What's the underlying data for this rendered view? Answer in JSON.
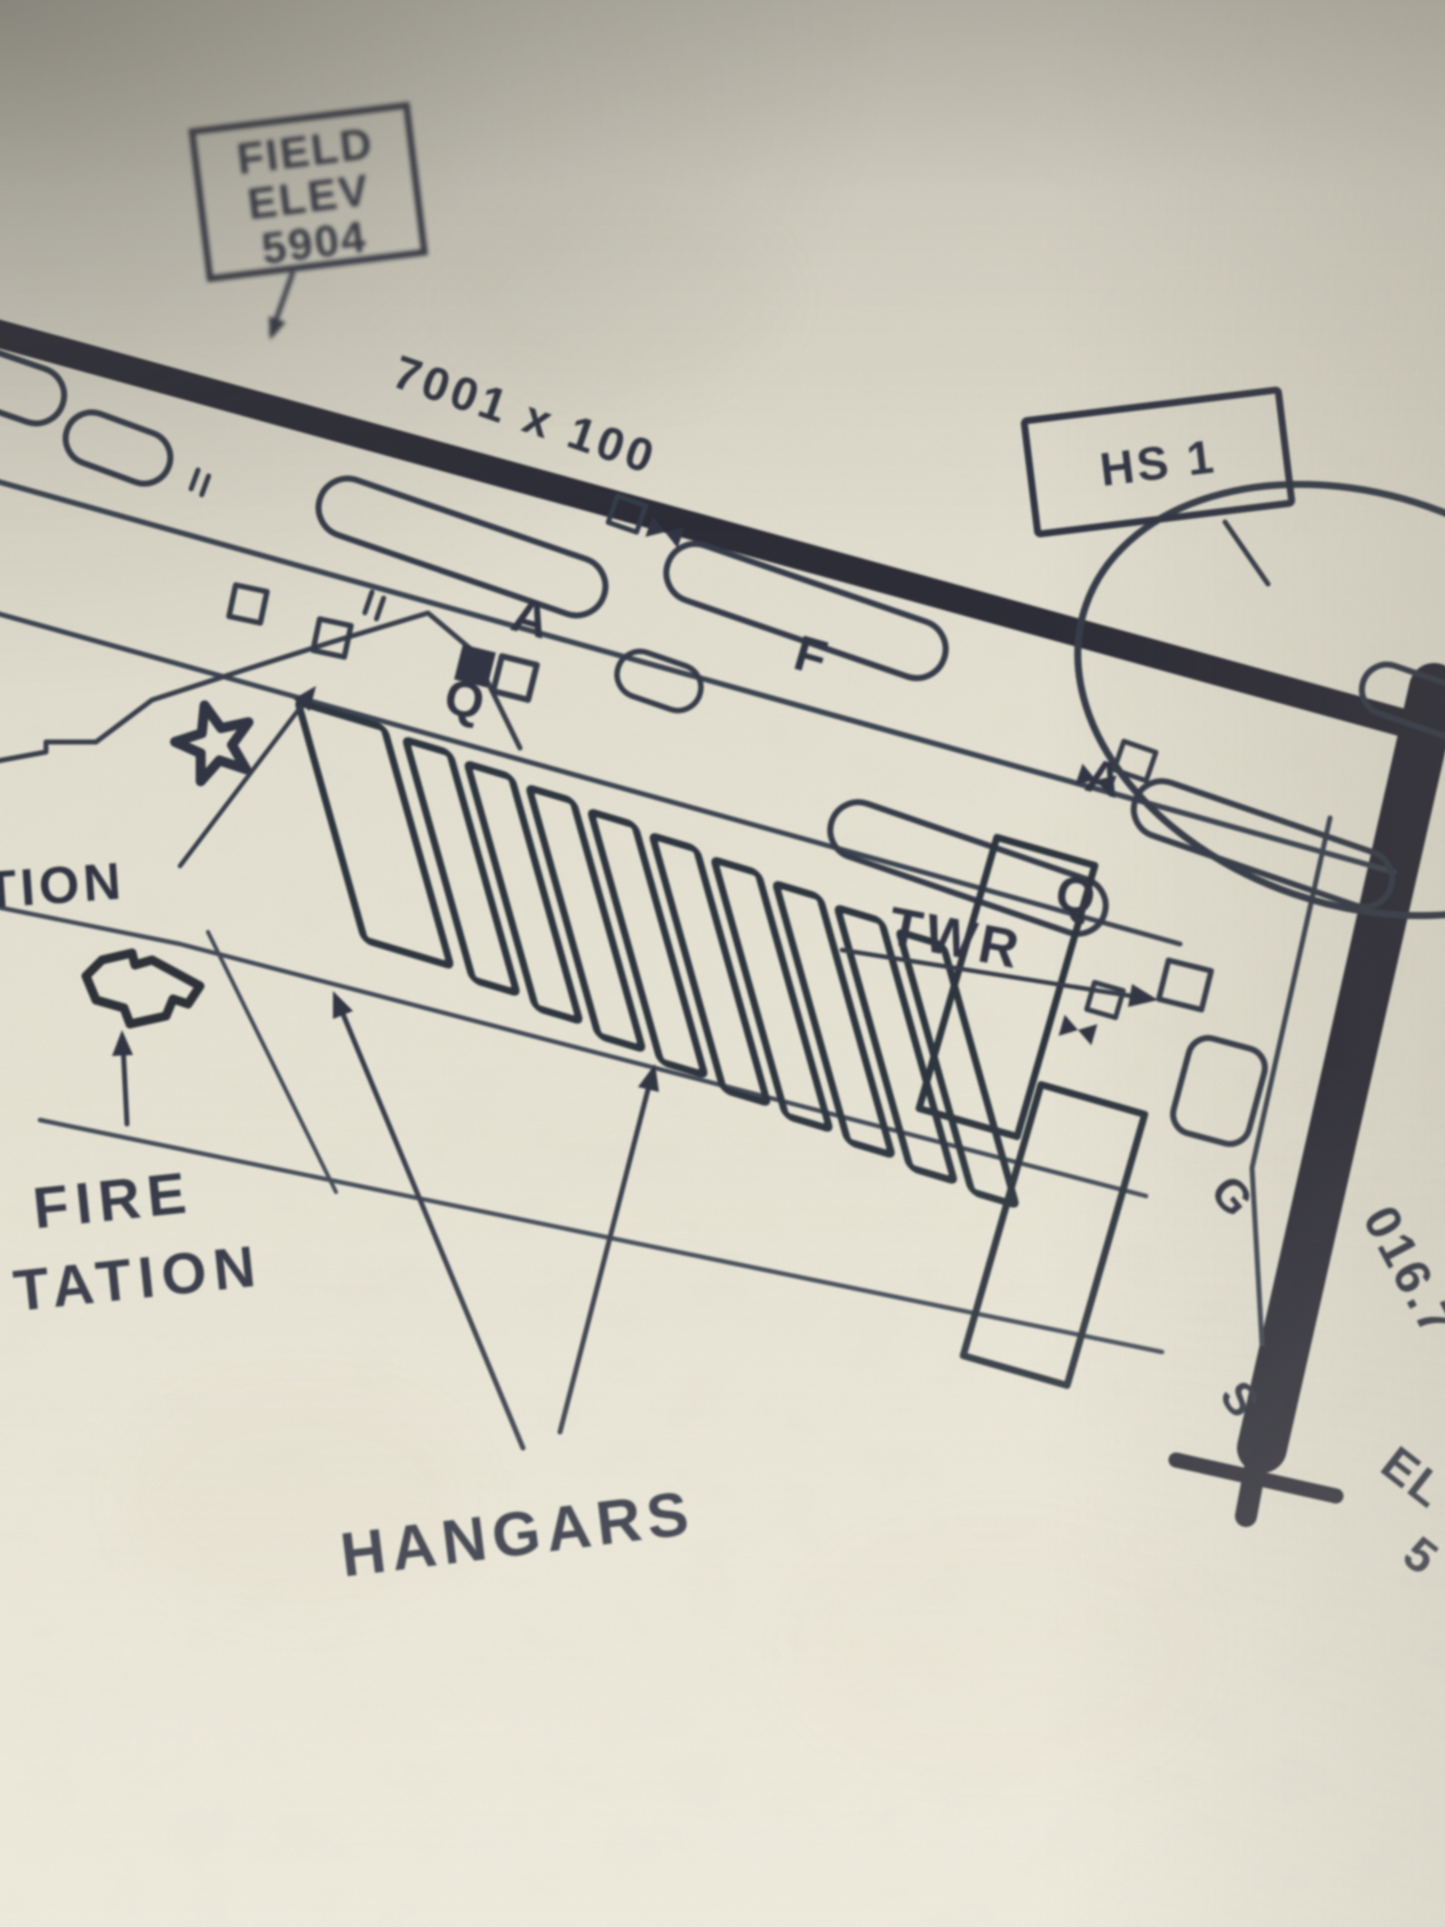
{
  "colors": {
    "paper": "#e7e4d5",
    "paper_dark": "#d3d0c4",
    "ink": "#262c3a",
    "runway_ink": "#20242e"
  },
  "labels": {
    "field_elev": {
      "line1": "FIELD",
      "line2": "ELEV",
      "line3": "5904"
    },
    "runway_size": "7001 x 100",
    "hot_spot": "HS 1",
    "taxiway_a_1": "A",
    "taxiway_q_1": "Q",
    "taxiway_f": "F",
    "taxiway_a_2": "A",
    "taxiway_q_2": "Q",
    "taxiway_g": "G",
    "taxiway_s": "S",
    "tower": "TWR",
    "clipped_station_top": "TION",
    "fire_station_line1": "FIRE",
    "fire_station_line2": "TATION",
    "hangars": "HANGARS",
    "runway_heading": "016.7",
    "runway_end_elev_line1": "EL",
    "runway_end_elev_line2": "5"
  }
}
